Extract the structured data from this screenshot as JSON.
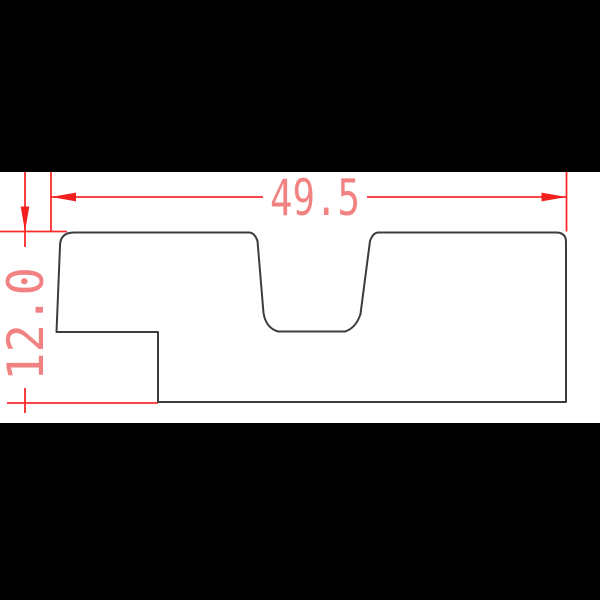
{
  "image": {
    "description": "Letterboxed CAD technical drawing of a board cross-section profile with a trapezoidal top groove and a bottom-left step notch",
    "background": "#ffffff"
  },
  "letterbox": {
    "color": "#000000",
    "top_band_height": "172",
    "bottom_band_y": "423"
  },
  "drawing": {
    "outline_color": "#3c3c3c",
    "dimension_line_color": "#fb2b2b",
    "dimension_arrow_color": "#f31f1f",
    "dimension_text_color": "#f28282",
    "width_dimension": {
      "label": "49.5",
      "orientation": "horizontal"
    },
    "height_dimension": {
      "label": "12.0",
      "orientation": "vertical-rotated-90ccw"
    }
  }
}
